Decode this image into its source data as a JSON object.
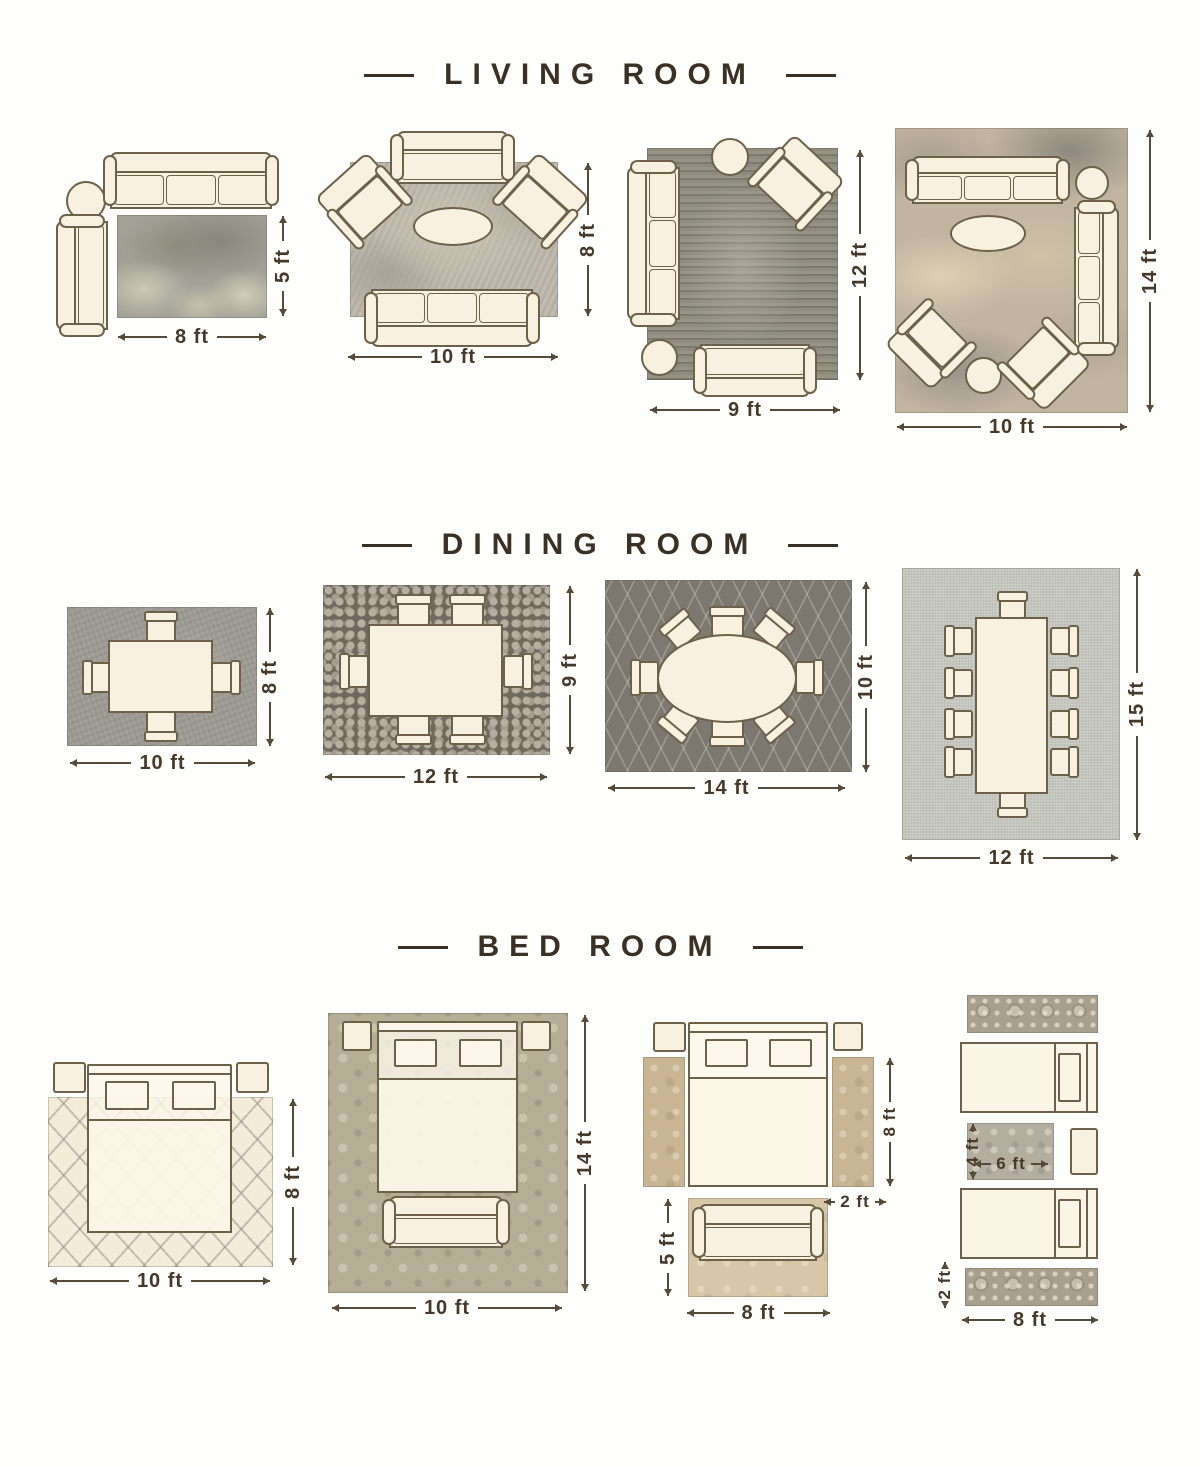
{
  "palette": {
    "background": "#fefefc",
    "title_text": "#3a3024",
    "dimension_text": "#46392a",
    "furniture_fill": "#f9f1e0",
    "furniture_outline": "#6d6149"
  },
  "sections": {
    "living": {
      "title": "LIVING ROOM",
      "layouts": {
        "l1": {
          "width": "8 ft",
          "height": "5 ft"
        },
        "l2": {
          "width": "10 ft",
          "height": "8 ft"
        },
        "l3": {
          "width": "9 ft",
          "height": "12 ft"
        },
        "l4": {
          "width": "10 ft",
          "height": "14 ft"
        }
      }
    },
    "dining": {
      "title": "DINING ROOM",
      "layouts": {
        "l1": {
          "width": "10 ft",
          "height": "8 ft"
        },
        "l2": {
          "width": "12 ft",
          "height": "9 ft"
        },
        "l3": {
          "width": "14 ft",
          "height": "10 ft"
        },
        "l4": {
          "width": "12 ft",
          "height": "15 ft"
        }
      }
    },
    "bedroom": {
      "title": "BED ROOM",
      "layouts": {
        "l1": {
          "width": "10 ft",
          "height": "8 ft"
        },
        "l2": {
          "width": "10 ft",
          "height": "14 ft"
        },
        "l3": {
          "runner_height": "8 ft",
          "runner_width": "2 ft",
          "foot_rug_height": "5 ft",
          "foot_rug_width": "8 ft"
        },
        "l4": {
          "between_rug_height": "4 ft",
          "between_rug_width": "6 ft",
          "runner_width": "2 ft",
          "runner_length": "8 ft"
        }
      }
    }
  }
}
